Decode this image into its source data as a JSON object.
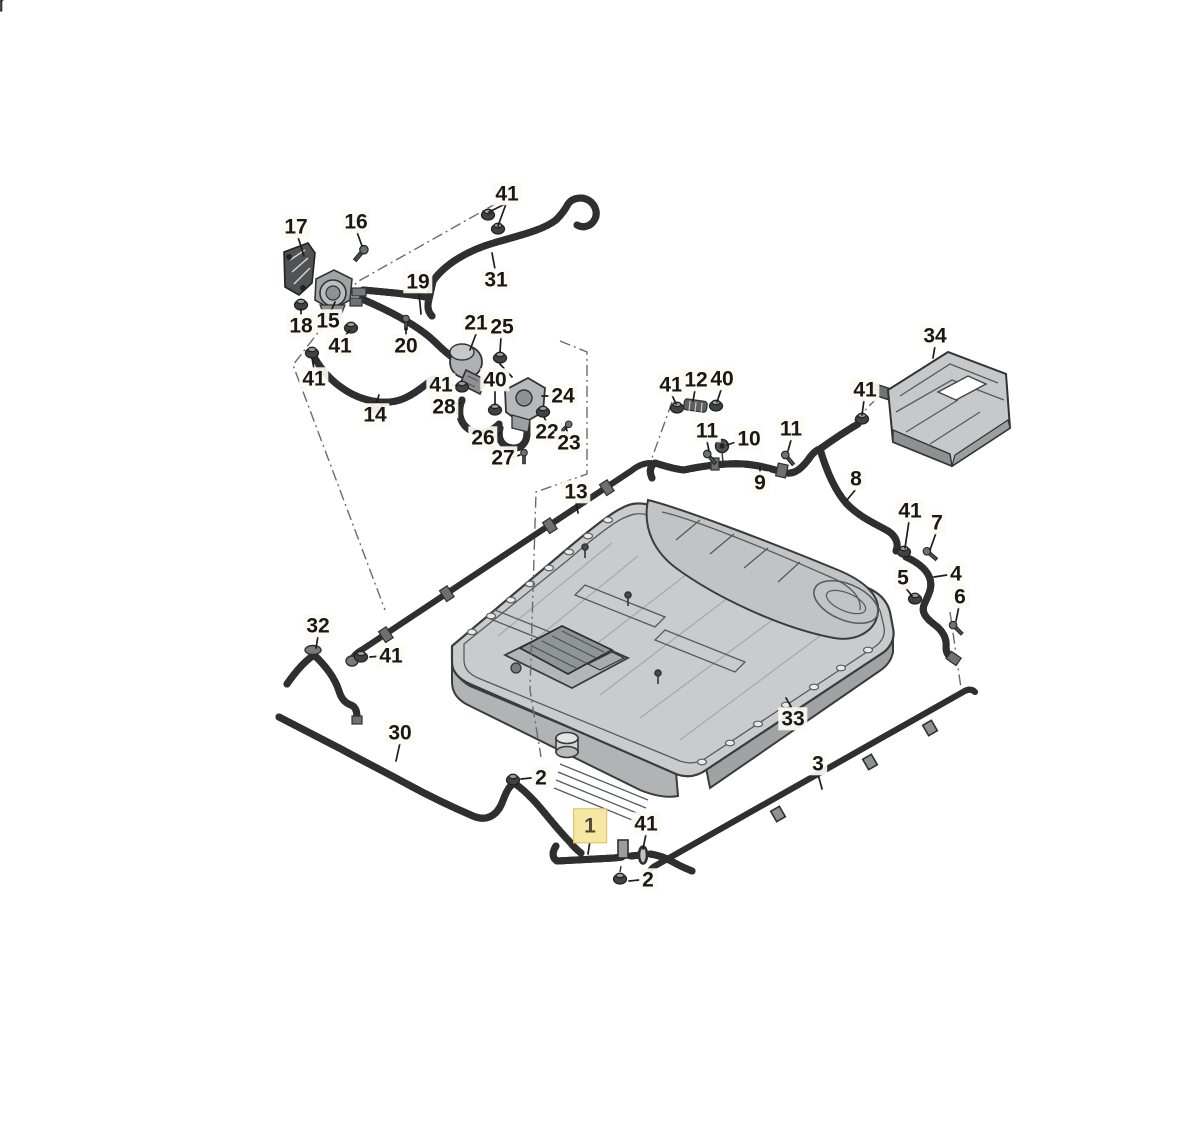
{
  "diagram": {
    "kind": "exploded-parts-diagram",
    "highlighted_callout": "1"
  },
  "colors": {
    "background": "#ffffff",
    "line_art": "#2f2f2f",
    "metal_light": "#c9cccc",
    "metal_mid": "#aeb2b3",
    "metal_dark": "#8d9192",
    "label_text": "#181818",
    "label_bg": "#fdfbf2",
    "highlight_bg": "#f6e7a2",
    "highlight_text": "#4c4738",
    "highlight_border": "#d9c065"
  },
  "callouts": [
    {
      "label": "17",
      "x": 296,
      "y": 227
    },
    {
      "label": "16",
      "x": 356,
      "y": 222
    },
    {
      "label": "41",
      "x": 507,
      "y": 194
    },
    {
      "label": "31",
      "x": 496,
      "y": 280
    },
    {
      "label": "19",
      "x": 418,
      "y": 282
    },
    {
      "label": "18",
      "x": 301,
      "y": 326
    },
    {
      "label": "15",
      "x": 328,
      "y": 321
    },
    {
      "label": "41",
      "x": 340,
      "y": 346
    },
    {
      "label": "20",
      "x": 406,
      "y": 346
    },
    {
      "label": "41",
      "x": 314,
      "y": 379
    },
    {
      "label": "14",
      "x": 375,
      "y": 415
    },
    {
      "label": "21",
      "x": 476,
      "y": 323
    },
    {
      "label": "25",
      "x": 502,
      "y": 327
    },
    {
      "label": "41",
      "x": 441,
      "y": 385
    },
    {
      "label": "40",
      "x": 495,
      "y": 380
    },
    {
      "label": "28",
      "x": 444,
      "y": 407
    },
    {
      "label": "24",
      "x": 563,
      "y": 396
    },
    {
      "label": "26",
      "x": 483,
      "y": 438
    },
    {
      "label": "22",
      "x": 547,
      "y": 432
    },
    {
      "label": "23",
      "x": 569,
      "y": 443
    },
    {
      "label": "27",
      "x": 503,
      "y": 458
    },
    {
      "label": "13",
      "x": 576,
      "y": 492
    },
    {
      "label": "34",
      "x": 935,
      "y": 336
    },
    {
      "label": "41",
      "x": 671,
      "y": 385
    },
    {
      "label": "12",
      "x": 696,
      "y": 380
    },
    {
      "label": "40",
      "x": 722,
      "y": 379
    },
    {
      "label": "11",
      "x": 707,
      "y": 431
    },
    {
      "label": "10",
      "x": 749,
      "y": 439
    },
    {
      "label": "11",
      "x": 791,
      "y": 429
    },
    {
      "label": "41",
      "x": 865,
      "y": 390
    },
    {
      "label": "9",
      "x": 760,
      "y": 483
    },
    {
      "label": "8",
      "x": 856,
      "y": 479
    },
    {
      "label": "41",
      "x": 910,
      "y": 511
    },
    {
      "label": "7",
      "x": 937,
      "y": 523
    },
    {
      "label": "5",
      "x": 903,
      "y": 578
    },
    {
      "label": "4",
      "x": 956,
      "y": 574
    },
    {
      "label": "6",
      "x": 960,
      "y": 597
    },
    {
      "label": "32",
      "x": 318,
      "y": 626
    },
    {
      "label": "41",
      "x": 391,
      "y": 656
    },
    {
      "label": "30",
      "x": 400,
      "y": 733
    },
    {
      "label": "2",
      "x": 541,
      "y": 778
    },
    {
      "label": "33",
      "x": 793,
      "y": 719
    },
    {
      "label": "3",
      "x": 818,
      "y": 764
    },
    {
      "label": "1",
      "x": 590,
      "y": 826,
      "highlight": true
    },
    {
      "label": "41",
      "x": 646,
      "y": 824
    },
    {
      "label": "2",
      "x": 648,
      "y": 880
    }
  ]
}
